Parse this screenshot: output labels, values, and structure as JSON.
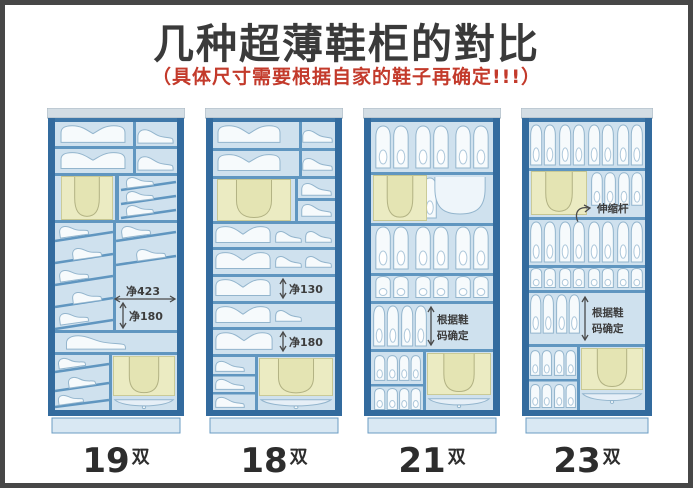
{
  "page": {
    "title": "几种超薄鞋柜的對比",
    "subtitle": "（具体尺寸需要根据自家的鞋子再确定!!!）"
  },
  "colors": {
    "page_border": "#474747",
    "cabinet_frame": "#336b9e",
    "shelf_blue": "#6096c0",
    "interior_blue": "#cfe1ee",
    "shoe_fill": "#f6fafc",
    "shoe_stroke": "#93b5cd",
    "boot_panel_yellow": "#ebebc2",
    "boot_panel_stroke": "#c6c691",
    "title_color": "#3a3a3a",
    "subtitle_red": "#c33a2b",
    "annotation_color": "#3c3c3c"
  },
  "cabinets": [
    {
      "label": {
        "num": "19",
        "unit": "双"
      },
      "annotations": {
        "width": "净423",
        "height": "净180"
      }
    },
    {
      "label": {
        "num": "18",
        "unit": "双"
      },
      "annotations": {
        "gap1": "净130",
        "gap2": "净180"
      }
    },
    {
      "label": {
        "num": "21",
        "unit": "双"
      },
      "annotations": {
        "note1": "根据鞋",
        "note2": "码确定"
      }
    },
    {
      "label": {
        "num": "23",
        "unit": "双"
      },
      "annotations": {
        "rod": "伸缩杆",
        "note1": "根据鞋",
        "note2": "码确定"
      }
    }
  ]
}
